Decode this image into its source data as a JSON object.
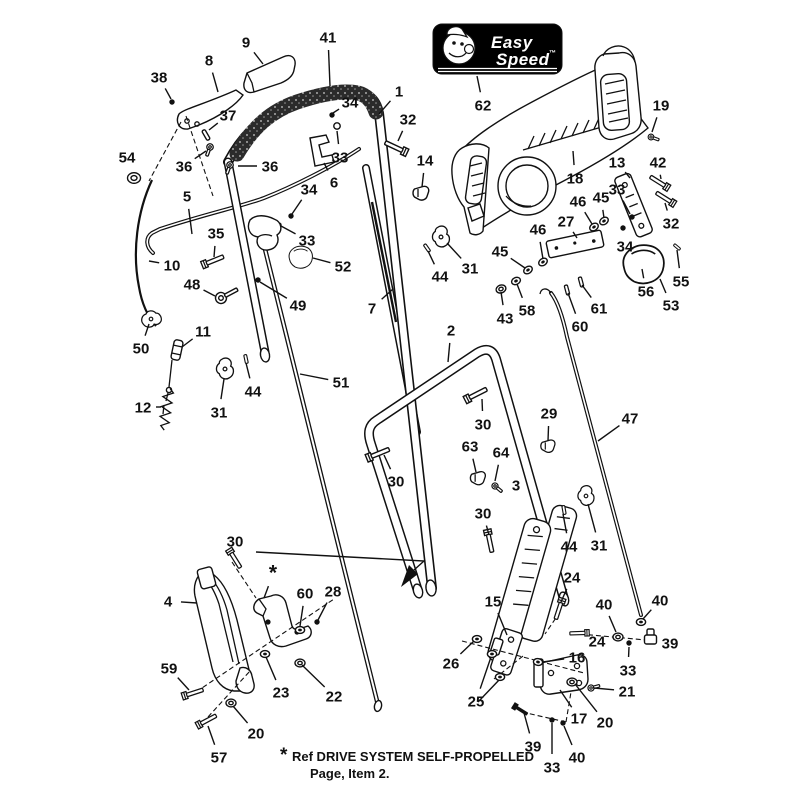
{
  "title": "Handle Assembly Exploded Parts Diagram",
  "colors": {
    "background": "#ffffff",
    "line": "#111111",
    "badge_bg": "#000000",
    "badge_fg": "#ffffff",
    "grip": "#2b2b2b"
  },
  "badge": {
    "brand_line1": "Easy",
    "brand_line2": "Speed",
    "trademark": "™",
    "callout": "62"
  },
  "note": {
    "star": "*",
    "line1": "Ref DRIVE SYSTEM SELF-PROPELLED",
    "line2": "Page, Item 2."
  },
  "callouts": [
    {
      "label": "38",
      "x": 159,
      "y": 77,
      "tx": 171,
      "ty": 99
    },
    {
      "label": "8",
      "x": 209,
      "y": 60,
      "tx": 218,
      "ty": 92
    },
    {
      "label": "9",
      "x": 246,
      "y": 42,
      "tx": 263,
      "ty": 64
    },
    {
      "label": "41",
      "x": 328,
      "y": 37,
      "tx": 330,
      "ty": 86
    },
    {
      "label": "37",
      "x": 228,
      "y": 115,
      "tx": 209,
      "ty": 130
    },
    {
      "label": "36",
      "x": 184,
      "y": 166,
      "tx": 206,
      "ty": 151
    },
    {
      "label": "36",
      "x": 270,
      "y": 166,
      "tx": 238,
      "ty": 166
    },
    {
      "label": "54",
      "x": 127,
      "y": 157,
      "tx": 134,
      "ty": 171
    },
    {
      "label": "34",
      "x": 350,
      "y": 102,
      "tx": 333,
      "ty": 113
    },
    {
      "label": "1",
      "x": 399,
      "y": 91,
      "tx": 379,
      "ty": 114
    },
    {
      "label": "32",
      "x": 408,
      "y": 119,
      "tx": 398,
      "ty": 141
    },
    {
      "label": "33",
      "x": 340,
      "y": 157,
      "tx": 337,
      "ty": 131
    },
    {
      "label": "6",
      "x": 334,
      "y": 182,
      "tx": 324,
      "ty": 163
    },
    {
      "label": "14",
      "x": 425,
      "y": 160,
      "tx": 422,
      "ty": 187
    },
    {
      "label": "62",
      "x": 483,
      "y": 105,
      "tx": 477,
      "ty": 76
    },
    {
      "label": "19",
      "x": 661,
      "y": 105,
      "tx": 652,
      "ty": 132
    },
    {
      "label": "18",
      "x": 575,
      "y": 178,
      "tx": 573,
      "ty": 151
    },
    {
      "label": "13",
      "x": 617,
      "y": 162,
      "tx": 630,
      "ty": 178
    },
    {
      "label": "42",
      "x": 658,
      "y": 162,
      "tx": 661,
      "ty": 179
    },
    {
      "label": "33",
      "x": 617,
      "y": 189,
      "tx": 630,
      "ty": 214
    },
    {
      "label": "46",
      "x": 578,
      "y": 201,
      "tx": 592,
      "ty": 224
    },
    {
      "label": "45",
      "x": 601,
      "y": 197,
      "tx": 604,
      "ty": 218
    },
    {
      "label": "27",
      "x": 566,
      "y": 221,
      "tx": 577,
      "ty": 238
    },
    {
      "label": "34",
      "x": 625,
      "y": 246,
      "tx": 623,
      "ty": 231
    },
    {
      "label": "32",
      "x": 671,
      "y": 223,
      "tx": 665,
      "ty": 203
    },
    {
      "label": "55",
      "x": 681,
      "y": 281,
      "tx": 677,
      "ty": 250
    },
    {
      "label": "56",
      "x": 646,
      "y": 291,
      "tx": 642,
      "ty": 269
    },
    {
      "label": "53",
      "x": 671,
      "y": 305,
      "tx": 660,
      "ty": 279
    },
    {
      "label": "61",
      "x": 599,
      "y": 308,
      "tx": 582,
      "ty": 285
    },
    {
      "label": "60",
      "x": 580,
      "y": 326,
      "tx": 568,
      "ty": 293
    },
    {
      "label": "45",
      "x": 500,
      "y": 251,
      "tx": 525,
      "ty": 268
    },
    {
      "label": "46",
      "x": 538,
      "y": 229,
      "tx": 543,
      "ty": 259
    },
    {
      "label": "43",
      "x": 505,
      "y": 318,
      "tx": 501,
      "ty": 292
    },
    {
      "label": "58",
      "x": 527,
      "y": 310,
      "tx": 517,
      "ty": 284
    },
    {
      "label": "5",
      "x": 187,
      "y": 196,
      "tx": 192,
      "ty": 234
    },
    {
      "label": "35",
      "x": 216,
      "y": 233,
      "tx": 214,
      "ty": 257
    },
    {
      "label": "10",
      "x": 172,
      "y": 265,
      "tx": 149,
      "ty": 261
    },
    {
      "label": "48",
      "x": 192,
      "y": 284,
      "tx": 215,
      "ty": 296
    },
    {
      "label": "34",
      "x": 309,
      "y": 189,
      "tx": 292,
      "ty": 214
    },
    {
      "label": "33",
      "x": 307,
      "y": 240,
      "tx": 281,
      "ty": 226
    },
    {
      "label": "52",
      "x": 343,
      "y": 266,
      "tx": 313,
      "ty": 258
    },
    {
      "label": "49",
      "x": 298,
      "y": 305,
      "tx": 260,
      "ty": 282
    },
    {
      "label": "7",
      "x": 372,
      "y": 308,
      "tx": 393,
      "ty": 289
    },
    {
      "label": "44",
      "x": 440,
      "y": 276,
      "tx": 428,
      "ty": 251
    },
    {
      "label": "31",
      "x": 470,
      "y": 268,
      "tx": 447,
      "ty": 243
    },
    {
      "label": "50",
      "x": 141,
      "y": 348,
      "tx": 149,
      "ty": 324
    },
    {
      "label": "11",
      "x": 203,
      "y": 331,
      "tx": 182,
      "ty": 347
    },
    {
      "label": "12",
      "x": 143,
      "y": 407,
      "tx": 161,
      "ty": 407
    },
    {
      "label": "31",
      "x": 219,
      "y": 412,
      "tx": 224,
      "ty": 379
    },
    {
      "label": "44",
      "x": 253,
      "y": 391,
      "tx": 246,
      "ty": 363
    },
    {
      "label": "51",
      "x": 341,
      "y": 382,
      "tx": 300,
      "ty": 374
    },
    {
      "label": "2",
      "x": 451,
      "y": 330,
      "tx": 448,
      "ty": 362
    },
    {
      "label": "30",
      "x": 483,
      "y": 424,
      "tx": 482,
      "ty": 399
    },
    {
      "label": "29",
      "x": 549,
      "y": 413,
      "tx": 548,
      "ty": 441
    },
    {
      "label": "47",
      "x": 630,
      "y": 418,
      "tx": 598,
      "ty": 441
    },
    {
      "label": "63",
      "x": 470,
      "y": 446,
      "tx": 476,
      "ty": 472
    },
    {
      "label": "64",
      "x": 501,
      "y": 452,
      "tx": 495,
      "ty": 481
    },
    {
      "label": "30",
      "x": 396,
      "y": 481,
      "tx": 384,
      "ty": 455
    },
    {
      "label": "3",
      "x": 516,
      "y": 485,
      "tx": 517,
      "ty": 499
    },
    {
      "label": "30",
      "x": 483,
      "y": 513,
      "tx": 489,
      "ty": 535
    },
    {
      "label": "44",
      "x": 569,
      "y": 546,
      "tx": 563,
      "ty": 514
    },
    {
      "label": "31",
      "x": 599,
      "y": 545,
      "tx": 588,
      "ty": 504
    },
    {
      "label": "24",
      "x": 572,
      "y": 577,
      "tx": 561,
      "ty": 602
    },
    {
      "label": "40",
      "x": 604,
      "y": 604,
      "tx": 616,
      "ty": 632
    },
    {
      "label": "40",
      "x": 660,
      "y": 600,
      "tx": 643,
      "ty": 619
    },
    {
      "label": "39",
      "x": 670,
      "y": 643,
      "tx": 655,
      "ty": 639
    },
    {
      "label": "24",
      "x": 597,
      "y": 641,
      "tx": 584,
      "ty": 634
    },
    {
      "label": "33",
      "x": 628,
      "y": 670,
      "tx": 629,
      "ty": 647
    },
    {
      "label": "16",
      "x": 577,
      "y": 657,
      "tx": 543,
      "ty": 662
    },
    {
      "label": "21",
      "x": 627,
      "y": 691,
      "tx": 594,
      "ty": 688
    },
    {
      "label": "17",
      "x": 579,
      "y": 718,
      "tx": 560,
      "ty": 690
    },
    {
      "label": "20",
      "x": 605,
      "y": 722,
      "tx": 575,
      "ty": 684
    },
    {
      "label": "15",
      "x": 493,
      "y": 601,
      "tx": 507,
      "ty": 635
    },
    {
      "label": "26",
      "x": 451,
      "y": 663,
      "tx": 474,
      "ty": 641
    },
    {
      "label": "25",
      "x": 476,
      "y": 701,
      "tx": 491,
      "ty": 657
    },
    {
      "label": "39",
      "x": 533,
      "y": 746,
      "tx": 524,
      "ty": 713
    },
    {
      "label": "33",
      "x": 552,
      "y": 767,
      "tx": 552,
      "ty": 723
    },
    {
      "label": "40",
      "x": 577,
      "y": 757,
      "tx": 564,
      "ty": 726
    },
    {
      "label": "30",
      "x": 235,
      "y": 541,
      "tx": 235,
      "ty": 553
    },
    {
      "label": "4",
      "x": 168,
      "y": 601,
      "tx": 197,
      "ty": 603
    },
    {
      "label": "*",
      "x": 273,
      "y": 574,
      "tx": 264,
      "ty": 598
    },
    {
      "label": "60",
      "x": 305,
      "y": 593,
      "tx": 300,
      "ty": 626
    },
    {
      "label": "28",
      "x": 333,
      "y": 591,
      "tx": 318,
      "ty": 620
    },
    {
      "label": "59",
      "x": 169,
      "y": 668,
      "tx": 189,
      "ty": 690
    },
    {
      "label": "23",
      "x": 281,
      "y": 692,
      "tx": 266,
      "ty": 657
    },
    {
      "label": "22",
      "x": 334,
      "y": 696,
      "tx": 302,
      "ty": 665
    },
    {
      "label": "20",
      "x": 256,
      "y": 733,
      "tx": 233,
      "ty": 706
    },
    {
      "label": "57",
      "x": 219,
      "y": 757,
      "tx": 208,
      "ty": 726
    }
  ],
  "extra_leaders": [
    {
      "x1": 478,
      "y1": 702,
      "x2": 500,
      "y2": 679
    }
  ],
  "dashed_lines": [
    {
      "x1": 186,
      "y1": 116,
      "x2": 213,
      "y2": 196
    },
    {
      "x1": 181,
      "y1": 122,
      "x2": 149,
      "y2": 181
    },
    {
      "x1": 196,
      "y1": 692,
      "x2": 334,
      "y2": 599
    },
    {
      "x1": 208,
      "y1": 717,
      "x2": 250,
      "y2": 671
    },
    {
      "x1": 232,
      "y1": 562,
      "x2": 256,
      "y2": 598
    },
    {
      "x1": 462,
      "y1": 641,
      "x2": 584,
      "y2": 673
    },
    {
      "x1": 494,
      "y1": 679,
      "x2": 523,
      "y2": 656
    },
    {
      "x1": 560,
      "y1": 612,
      "x2": 545,
      "y2": 634
    },
    {
      "x1": 580,
      "y1": 634,
      "x2": 646,
      "y2": 640
    },
    {
      "x1": 522,
      "y1": 712,
      "x2": 566,
      "y2": 722
    },
    {
      "x1": 566,
      "y1": 722,
      "x2": 571,
      "y2": 692
    }
  ],
  "hardware": [
    {
      "type": "dot",
      "x": 172,
      "y": 102
    },
    {
      "type": "pin",
      "x": 206,
      "y": 135,
      "r": 60
    },
    {
      "type": "screw",
      "x": 210,
      "y": 147,
      "r": 110,
      "s": 0.9
    },
    {
      "type": "screw",
      "x": 230,
      "y": 165,
      "r": 110,
      "s": 0.9
    },
    {
      "type": "ring",
      "x": 134,
      "y": 178
    },
    {
      "type": "dot",
      "x": 332,
      "y": 115
    },
    {
      "type": "circle",
      "x": 337,
      "y": 126
    },
    {
      "type": "bolt",
      "x": 399,
      "y": 149,
      "r": -155
    },
    {
      "type": "clipsm",
      "x": 421,
      "y": 193
    },
    {
      "type": "screw",
      "x": 651,
      "y": 137,
      "r": 20,
      "s": 0.8
    },
    {
      "type": "bolt",
      "x": 662,
      "y": 184,
      "r": -148,
      "s": 0.9
    },
    {
      "type": "bolt",
      "x": 668,
      "y": 200,
      "r": -148,
      "s": 0.9
    },
    {
      "type": "dot",
      "x": 632,
      "y": 217
    },
    {
      "type": "nut",
      "x": 594,
      "y": 227,
      "r": -35
    },
    {
      "type": "nut",
      "x": 604,
      "y": 221,
      "r": -35
    },
    {
      "type": "dot",
      "x": 623,
      "y": 228
    },
    {
      "type": "pin",
      "x": 677,
      "y": 247,
      "r": 40,
      "s": 0.7
    },
    {
      "type": "dot",
      "x": 642,
      "y": 266
    },
    {
      "type": "pin",
      "x": 581,
      "y": 282,
      "r": 75,
      "s": 0.9
    },
    {
      "type": "pin",
      "x": 567,
      "y": 290,
      "r": 75,
      "s": 0.9
    },
    {
      "type": "nut",
      "x": 528,
      "y": 270,
      "r": -35
    },
    {
      "type": "nut",
      "x": 543,
      "y": 262,
      "r": -35
    },
    {
      "type": "washer",
      "x": 501,
      "y": 289,
      "r": -20
    },
    {
      "type": "nut",
      "x": 516,
      "y": 281,
      "r": -25
    },
    {
      "type": "bolt",
      "x": 210,
      "y": 262,
      "r": -22,
      "s": 0.95
    },
    {
      "type": "eyebolt",
      "x": 221,
      "y": 298,
      "r": -28
    },
    {
      "type": "dot",
      "x": 291,
      "y": 216
    },
    {
      "type": "dot",
      "x": 279,
      "y": 225
    },
    {
      "type": "knob",
      "x": 301,
      "y": 257,
      "s": 0.72
    },
    {
      "type": "dot",
      "x": 258,
      "y": 280
    },
    {
      "type": "trigger",
      "x": 264,
      "y": 232
    },
    {
      "type": "clip",
      "x": 441,
      "y": 237,
      "s": 0.95
    },
    {
      "type": "pin",
      "x": 427,
      "y": 248,
      "r": 55,
      "s": 0.8
    },
    {
      "type": "clip",
      "x": 225,
      "y": 369,
      "s": 0.95
    },
    {
      "type": "pin",
      "x": 246,
      "y": 359,
      "r": 78,
      "s": 0.8
    },
    {
      "type": "clip",
      "x": 151,
      "y": 319,
      "r": 85,
      "s": 0.9
    },
    {
      "type": "barrel",
      "x": 177,
      "y": 350,
      "r": 12
    },
    {
      "type": "spring",
      "x": 165,
      "y": 410,
      "r": 8
    },
    {
      "type": "bolt",
      "x": 473,
      "y": 396,
      "r": -27
    },
    {
      "type": "clipsm",
      "x": 548,
      "y": 446,
      "s": 0.9
    },
    {
      "type": "clipsm",
      "x": 478,
      "y": 478,
      "s": 0.95
    },
    {
      "type": "screw",
      "x": 495,
      "y": 486,
      "r": 40,
      "s": 0.85
    },
    {
      "type": "bolt",
      "x": 375,
      "y": 455,
      "r": -22
    },
    {
      "type": "bolt",
      "x": 489,
      "y": 538,
      "r": 78,
      "s": 0.95
    },
    {
      "type": "pin",
      "x": 564,
      "y": 510,
      "r": 80,
      "s": 0.8
    },
    {
      "type": "clip",
      "x": 586,
      "y": 496,
      "s": 0.9
    },
    {
      "type": "bolt",
      "x": 560,
      "y": 606,
      "r": 108,
      "s": 0.9
    },
    {
      "type": "washer",
      "x": 618,
      "y": 637
    },
    {
      "type": "nut",
      "x": 641,
      "y": 622
    },
    {
      "type": "fitting",
      "x": 650,
      "y": 638
    },
    {
      "type": "bolt",
      "x": 582,
      "y": 633,
      "r": 178,
      "s": 0.8
    },
    {
      "type": "dot",
      "x": 629,
      "y": 643
    },
    {
      "type": "nut",
      "x": 538,
      "y": 662,
      "r": 10
    },
    {
      "type": "screw",
      "x": 591,
      "y": 688,
      "r": -15,
      "s": 0.85
    },
    {
      "type": "washer",
      "x": 572,
      "y": 682
    },
    {
      "type": "nut",
      "x": 477,
      "y": 639
    },
    {
      "type": "nut",
      "x": 492,
      "y": 654
    },
    {
      "type": "nut",
      "x": 500,
      "y": 677
    },
    {
      "type": "boltdark",
      "x": 519,
      "y": 709,
      "r": 32,
      "s": 0.8
    },
    {
      "type": "dot",
      "x": 552,
      "y": 720
    },
    {
      "type": "dot",
      "x": 563,
      "y": 723
    },
    {
      "type": "bolt",
      "x": 233,
      "y": 556,
      "r": 58,
      "s": 0.9
    },
    {
      "type": "nut",
      "x": 300,
      "y": 630
    },
    {
      "type": "dot",
      "x": 317,
      "y": 622
    },
    {
      "type": "bolt",
      "x": 190,
      "y": 694,
      "r": -18,
      "s": 0.9
    },
    {
      "type": "nut",
      "x": 265,
      "y": 654
    },
    {
      "type": "washer",
      "x": 300,
      "y": 663
    },
    {
      "type": "washer",
      "x": 231,
      "y": 703
    },
    {
      "type": "bolt",
      "x": 204,
      "y": 722,
      "r": -28,
      "s": 0.9
    },
    {
      "type": "plate",
      "x": 575,
      "y": 244,
      "r": -12
    },
    {
      "type": "knob",
      "x": 644,
      "y": 264,
      "s": 1.25
    }
  ]
}
